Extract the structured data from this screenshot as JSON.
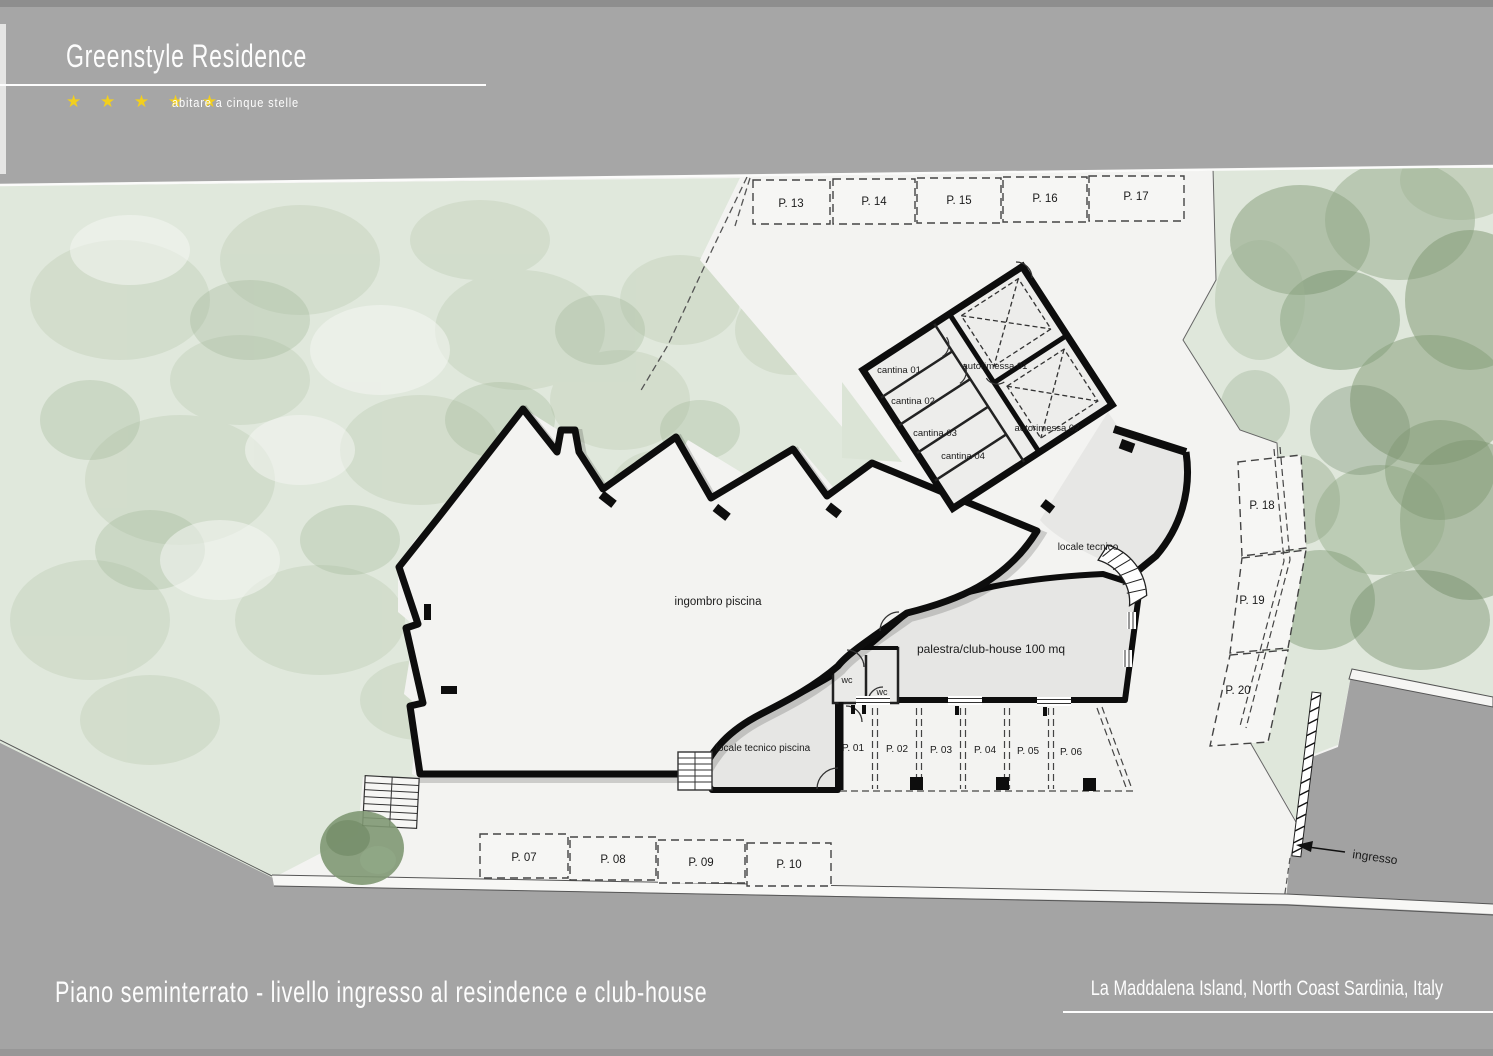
{
  "header": {
    "title": "Greenstyle Residence",
    "stars": "★ ★ ★ ★ ★",
    "star_count": 5,
    "tagline": "abitare a cinque stelle"
  },
  "footer": {
    "plan_title": "Piano seminterrato - livello ingresso al resindence e club-house",
    "location": "La Maddalena Island, North Coast Sardinia, Italy"
  },
  "plan": {
    "labels": {
      "pool": "ingombro piscina",
      "pool_tech": "locale tecnico piscina",
      "gym": "palestra/club-house 100 mq",
      "tech_room": "locale tecnico",
      "wc_a": "wc",
      "wc_b": "wc",
      "cantina_1": "cantina 01",
      "cantina_2": "cantina 02",
      "cantina_3": "cantina 03",
      "cantina_4": "cantina 04",
      "garage_1": "autorimessa 01",
      "garage_2": "autorimessa 02",
      "entrance": "ingresso"
    },
    "parking_top": [
      "P. 13",
      "P. 14",
      "P. 15",
      "P. 16",
      "P. 17"
    ],
    "parking_garage": [
      "P. 01",
      "P. 02",
      "P. 03",
      "P. 04",
      "P. 05",
      "P. 06"
    ],
    "parking_bottom": [
      "P. 07",
      "P. 08",
      "P. 09",
      "P. 10"
    ],
    "parking_right": [
      "P. 18",
      "P. 19",
      "P. 20"
    ]
  },
  "colors": {
    "star_yellow": "#f2cf1d",
    "band_gray": "#a6a6a6",
    "road_gray": "#a4a4a4",
    "lot_white": "#f3f3f1",
    "vegetation_base": "#e0e8dc",
    "tree_green": "#7e9671",
    "wall_black": "#0d0d0d"
  }
}
